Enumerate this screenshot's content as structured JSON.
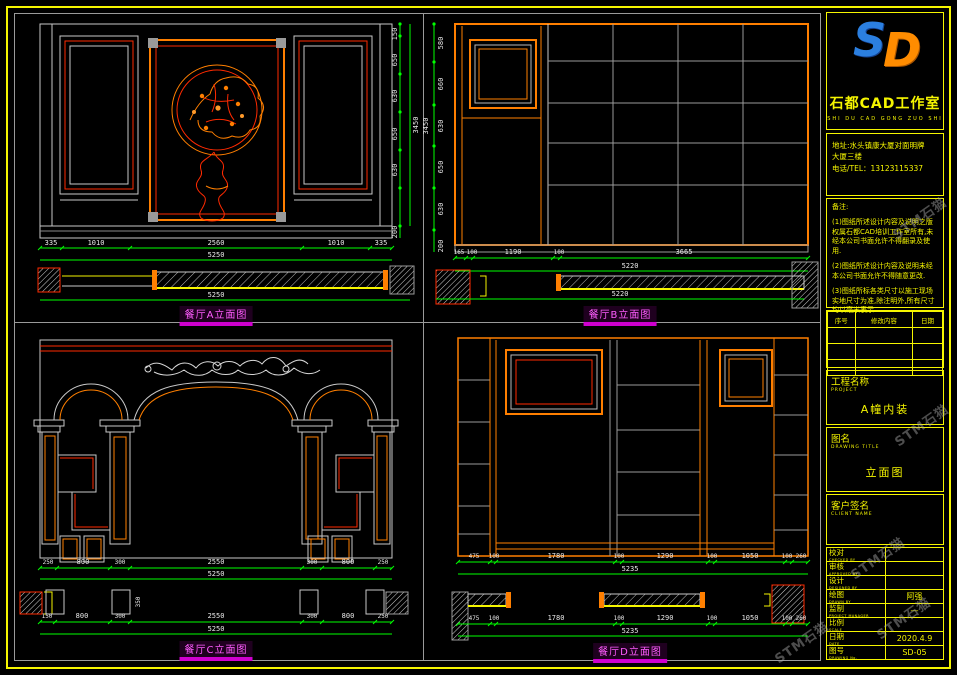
{
  "sheet": {
    "studio_name": "石都CAD工作室",
    "studio_pinyin": "SHI DU CAD GONG ZUO SHI",
    "logo_text": {
      "s": "S",
      "d": "D"
    },
    "address_line1": "地址:水头镇康大厦对面明牌",
    "address_line2": "大厦三楼",
    "phone": "电话/TEL：13123115337",
    "notes_title": "备注:",
    "notes": [
      "(1)图纸所述设计内容及说明之版权属石都CAD培训工作室所有,未经本公司书面允许不得翻录及使用.",
      "(2)图纸所述设计内容及说明未经本公司书面允许不得随意更改.",
      "(3)图纸所标各类尺寸以施工现场实地尺寸为准,除注明外,所有尺寸均以毫米表示."
    ],
    "revision_headers": [
      "序号",
      "修改内容",
      "日期"
    ],
    "watermark": "STM石猫"
  },
  "titleblock": {
    "project_label": "工程名称",
    "project_en": "PROJECT",
    "project_value": "A幢内装",
    "drawing_label": "图名",
    "drawing_en": "DRAWING TITLE",
    "drawing_value": "立面图",
    "client_label": "客户签名",
    "client_en": "CLIENT NAME",
    "rows": [
      {
        "label": "校对",
        "en": "CHECKED BY",
        "value": ""
      },
      {
        "label": "审核",
        "en": "APPROVED BY",
        "value": ""
      },
      {
        "label": "设计",
        "en": "DESIGNED BY",
        "value": ""
      },
      {
        "label": "绘图",
        "en": "DRAWN BY",
        "value": "阿强"
      },
      {
        "label": "监制",
        "en": "PROJECT MANAGER",
        "value": "—"
      },
      {
        "label": "比例",
        "en": "SCALE",
        "value": ""
      },
      {
        "label": "日期",
        "en": "DATE",
        "value": "2020.4.9"
      },
      {
        "label": "图号",
        "en": "DRAWING No.",
        "value": "SD-05"
      }
    ]
  },
  "drawings": {
    "a": {
      "caption": "餐厅A立面图",
      "bottom_dims": [
        "335",
        "1010",
        "2560",
        "1010",
        "335"
      ],
      "bottom_total": "5250",
      "right_dims": [
        "150",
        "650",
        "630",
        "650",
        "630"
      ],
      "right_total": "3450",
      "base_dim": "200",
      "plan_total": "5250"
    },
    "b": {
      "caption": "餐厅B立面图",
      "bottom_dims": [
        "165",
        "100",
        "1190",
        "100",
        "3665"
      ],
      "bottom_total": "5220",
      "left_dims": [
        "580",
        "660",
        "630",
        "650",
        "630"
      ],
      "left_total": "3450",
      "base_dim": "200",
      "plan_total": "5220"
    },
    "c": {
      "caption": "餐厅C立面图",
      "bottom_dims": [
        "250",
        "800",
        "300",
        "2550",
        "300",
        "800",
        "250"
      ],
      "bottom_total": "5250",
      "plan_dims": [
        "150",
        "800",
        "300",
        "2550",
        "300",
        "800",
        "250"
      ],
      "plan_total": "5250",
      "column_dim": "350"
    },
    "d": {
      "caption": "餐厅D立面图",
      "bottom_dims": [
        "475",
        "100",
        "1780",
        "100",
        "1290",
        "100",
        "1050",
        "100",
        "260"
      ],
      "bottom_total": "5235",
      "plan_dims": [
        "475",
        "100",
        "1780",
        "100",
        "1290",
        "100",
        "1050",
        "100",
        "260"
      ],
      "plan_total": "5235"
    }
  },
  "colors": {
    "border": "#f5f500",
    "dim_line": "#00ff00",
    "line": "#c8c8c8",
    "accent_red": "#ff2a00",
    "accent_orange": "#ff7f00",
    "caption": "#ff00ff"
  }
}
